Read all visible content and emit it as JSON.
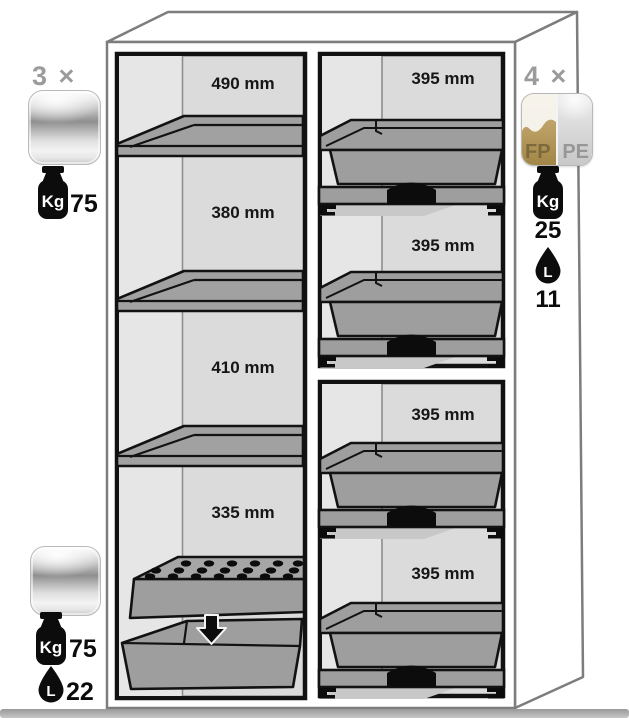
{
  "diagram": {
    "left_column": {
      "labels": [
        "490 mm",
        "380 mm",
        "410 mm",
        "335 mm"
      ]
    },
    "right_column": {
      "labels": [
        "395 mm",
        "395 mm",
        "395 mm",
        "395 mm"
      ]
    }
  },
  "annotations": {
    "shelf_top": {
      "count": "3 ×",
      "unit_kg": "Kg",
      "weight": "75"
    },
    "shelf_bottom": {
      "unit_kg": "Kg",
      "weight": "75",
      "unit_l": "L",
      "volume": "22"
    },
    "tray_right": {
      "count": "4 ×",
      "material_left": "FP",
      "material_right": "PE",
      "unit_kg": "Kg",
      "weight": "25",
      "unit_l": "L",
      "volume": "11"
    }
  },
  "colors": {
    "interior_gray": "#dbdbdb",
    "equipment_gray": "#9e9e9e",
    "outline_black": "#121212",
    "cabinet_line": "#7d7d7d",
    "count_gray": "#9b9b9b",
    "fp_gold": "#b89c60"
  }
}
